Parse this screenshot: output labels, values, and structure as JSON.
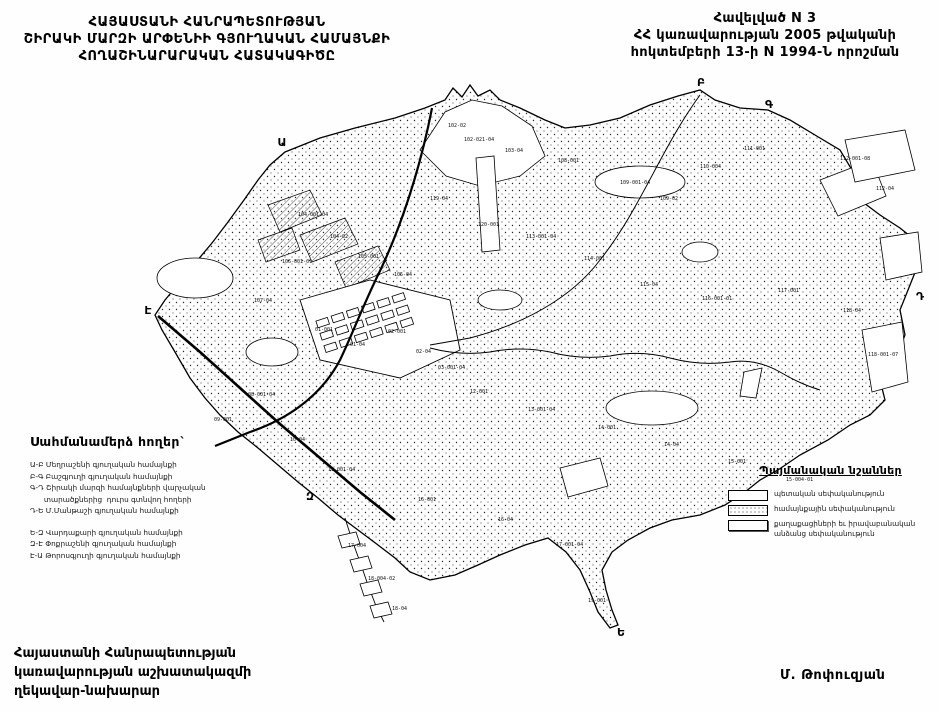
{
  "header": {
    "title_lines": [
      "ՀԱՅԱՍՏԱՆԻ ՀԱՆՐԱՊԵՏՈՒԹՅԱՆ",
      "ՇԻՐԱԿԻ ՄԱՐԶԻ ԱՐՓԵՆԻԻ ԳՅՈՒՂԱԿԱՆ ՀԱՄԱՅՆՔԻ",
      "ՀՈՂԱՇԻՆԱՐԱՐԱԿԱՆ ՀԱՏԱԿԱԳԻԾԸ"
    ],
    "appendix_lines": [
      "Հավելված N  3",
      "ՀՀ կառավարության 2005 թվականի",
      "հոկտեմբերի 13-ի N 1994-Ն որոշման"
    ]
  },
  "border_lands": {
    "heading": "Սահմանամերձ հողեր`",
    "lines": [
      "Ա-Բ Մեղրաշենի գյուղական համայնքի",
      "Բ-Գ Բաշգյուղի գյուղական համայնքի",
      "Գ-Դ Շիրակի մարզի համայնքների վարչական",
      "      տարածքներից  դուրս գտնվող հողերի",
      "Դ-Ե Մ.Մանթաշի գյուղական համայնքի",
      "",
      "Ե-Զ Վարդաքարի գյուղական համայնքի",
      "Զ-Է Փոքրաշենի գյուղական համայնքի",
      "Է-Ա Թորոսգյուղի գյուղական համայնքի"
    ]
  },
  "legend": {
    "heading": "Պայմանական նշաններ",
    "items": [
      {
        "swatch": "state",
        "lines": [
          "պետական սեփականություն"
        ]
      },
      {
        "swatch": "community",
        "lines": [
          "համայնքային սեփականություն"
        ]
      },
      {
        "swatch": "citizens",
        "lines": [
          "քաղաքացիների եւ իրավաբանական",
          "անձանց սեփականություն"
        ]
      }
    ]
  },
  "footer": {
    "left_lines": [
      "Հայաստանի Հանրապետության",
      "կառավարության աշխատակազմի",
      "ղեկավար-նախարար"
    ],
    "signature": "Մ. Թոփուզյան"
  },
  "map": {
    "border_points": [
      {
        "label": "Ա",
        "x": 282,
        "y": 146
      },
      {
        "label": "Բ",
        "x": 701,
        "y": 86
      },
      {
        "label": "Գ",
        "x": 769,
        "y": 108
      },
      {
        "label": "Դ",
        "x": 920,
        "y": 300
      },
      {
        "label": "Ե",
        "x": 621,
        "y": 636
      },
      {
        "label": "Զ",
        "x": 310,
        "y": 500
      },
      {
        "label": "Է",
        "x": 148,
        "y": 314
      }
    ],
    "parcel_labels": [
      {
        "text": "102-02",
        "x": 448,
        "y": 127
      },
      {
        "text": "102-021-04",
        "x": 464,
        "y": 141
      },
      {
        "text": "103-04",
        "x": 505,
        "y": 152
      },
      {
        "text": "108-001",
        "x": 558,
        "y": 162
      },
      {
        "text": "109-001-04",
        "x": 620,
        "y": 184
      },
      {
        "text": "109-02",
        "x": 660,
        "y": 200
      },
      {
        "text": "110-004",
        "x": 700,
        "y": 168
      },
      {
        "text": "111-001",
        "x": 744,
        "y": 150
      },
      {
        "text": "112-001-08",
        "x": 840,
        "y": 160
      },
      {
        "text": "112-04",
        "x": 876,
        "y": 190
      },
      {
        "text": "113-001-04",
        "x": 526,
        "y": 238
      },
      {
        "text": "114-001",
        "x": 584,
        "y": 260
      },
      {
        "text": "115-04",
        "x": 640,
        "y": 286
      },
      {
        "text": "116-001-01",
        "x": 702,
        "y": 300
      },
      {
        "text": "117-001",
        "x": 778,
        "y": 292
      },
      {
        "text": "118-04",
        "x": 843,
        "y": 312
      },
      {
        "text": "118-001-07",
        "x": 868,
        "y": 356
      },
      {
        "text": "104-001-04",
        "x": 298,
        "y": 216
      },
      {
        "text": "104-02",
        "x": 330,
        "y": 238
      },
      {
        "text": "105-001",
        "x": 358,
        "y": 258
      },
      {
        "text": "105-04",
        "x": 394,
        "y": 276
      },
      {
        "text": "106-001-01",
        "x": 282,
        "y": 263
      },
      {
        "text": "107-04",
        "x": 254,
        "y": 302
      },
      {
        "text": "119-04",
        "x": 430,
        "y": 200
      },
      {
        "text": "120-001",
        "x": 478,
        "y": 226
      },
      {
        "text": "01-001",
        "x": 315,
        "y": 331
      },
      {
        "text": "01-04",
        "x": 350,
        "y": 346
      },
      {
        "text": "02-001",
        "x": 388,
        "y": 333
      },
      {
        "text": "02-04",
        "x": 416,
        "y": 353
      },
      {
        "text": "03-001-04",
        "x": 438,
        "y": 369
      },
      {
        "text": "12-001",
        "x": 470,
        "y": 393
      },
      {
        "text": "13-001-04",
        "x": 528,
        "y": 411
      },
      {
        "text": "14-001",
        "x": 598,
        "y": 429
      },
      {
        "text": "14-04",
        "x": 664,
        "y": 446
      },
      {
        "text": "15-001",
        "x": 728,
        "y": 463
      },
      {
        "text": "15-004-01",
        "x": 786,
        "y": 481
      },
      {
        "text": "08-001-04",
        "x": 248,
        "y": 396
      },
      {
        "text": "09-001",
        "x": 214,
        "y": 421
      },
      {
        "text": "10-04",
        "x": 290,
        "y": 441
      },
      {
        "text": "11-001-04",
        "x": 328,
        "y": 471
      },
      {
        "text": "16-001",
        "x": 418,
        "y": 501
      },
      {
        "text": "16-04",
        "x": 498,
        "y": 521
      },
      {
        "text": "17-001-04",
        "x": 556,
        "y": 546
      },
      {
        "text": "17-004",
        "x": 348,
        "y": 547
      },
      {
        "text": "18-004-02",
        "x": 368,
        "y": 580
      },
      {
        "text": "18-04",
        "x": 392,
        "y": 610
      },
      {
        "text": "19-001",
        "x": 588,
        "y": 602
      }
    ]
  }
}
